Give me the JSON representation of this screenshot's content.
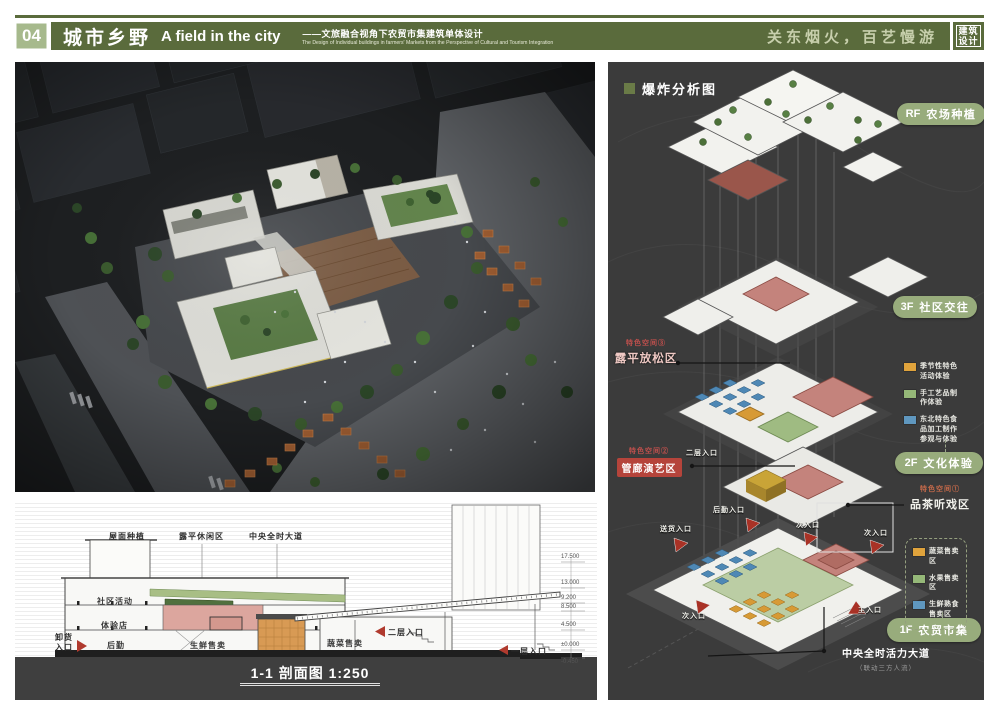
{
  "header": {
    "number": "04",
    "title_cn": "城市乡野",
    "title_en": "A field in the city",
    "subtitle_cn": "——文旅融合视角下农贸市集建筑单体设计",
    "subtitle_en": "The Design of Individual buildings in farmers' Markets from the Perspective of Cultural and Tourism Integration",
    "slogan": "关东烟火，百艺慢游",
    "badge": [
      "建筑",
      "设计"
    ],
    "colors": {
      "band": "#5A6B3C",
      "number_bg": "#A6B98C",
      "slogan": "#C7CFAC"
    }
  },
  "exploded": {
    "title": "爆炸分析图",
    "pill_color": "#98AC7C",
    "floor_tags": [
      {
        "code": "RF",
        "label": "农场种植"
      },
      {
        "code": "3F",
        "label": "社区交往"
      },
      {
        "code": "2F",
        "label": "文化体验"
      },
      {
        "code": "1F",
        "label": "农贸市集"
      }
    ],
    "legend_2f": [
      {
        "color": "#E0A33C",
        "label": "季节性特色活动体验"
      },
      {
        "color": "#95B878",
        "label": "手工艺品制作体验"
      },
      {
        "color": "#5F97BF",
        "label": "东北特色食品加工制作参观与体验"
      }
    ],
    "legend_1f": [
      {
        "color": "#E0A33C",
        "label": "蔬菜售卖区"
      },
      {
        "color": "#95B878",
        "label": "水果售卖区"
      },
      {
        "color": "#5F97BF",
        "label": "生鲜熟食售卖区"
      }
    ],
    "special_spaces": [
      {
        "tag": "特色空间③",
        "name": "露平放松区"
      },
      {
        "tag": "特色空间②",
        "name": "管廊演艺区"
      },
      {
        "tag": "特色空间①",
        "name": "品茶听戏区"
      }
    ],
    "entrances": {
      "houqin": "后勤入口",
      "songhuo": "送货入口",
      "ci1": "次入口",
      "ci2": "次入口",
      "ci3": "次入口",
      "zhu": "主入口",
      "erceng": "二层入口"
    },
    "avenue": {
      "label": "中央全时活力大道",
      "sub": "（联动三方人流）"
    }
  },
  "section": {
    "top_labels": [
      "屋面种植",
      "露平休闲区",
      "中央全时大道"
    ],
    "rooms": {
      "shequ": "社区活动",
      "tiyan": "体验店",
      "houqin": "后勤",
      "shengxian": "生鲜售卖",
      "shucai": "蔬菜售卖"
    },
    "entrances": {
      "xiehuo1": "卸货",
      "xiehuo2": "入口",
      "erceng": "二层入口",
      "yiceng": "一层入口"
    },
    "elevations": [
      "17.500",
      "13.000",
      "9.200",
      "8.500",
      "4.500",
      "±0.000",
      "-0.450"
    ],
    "title": "1-1 剖面图 1:250"
  }
}
